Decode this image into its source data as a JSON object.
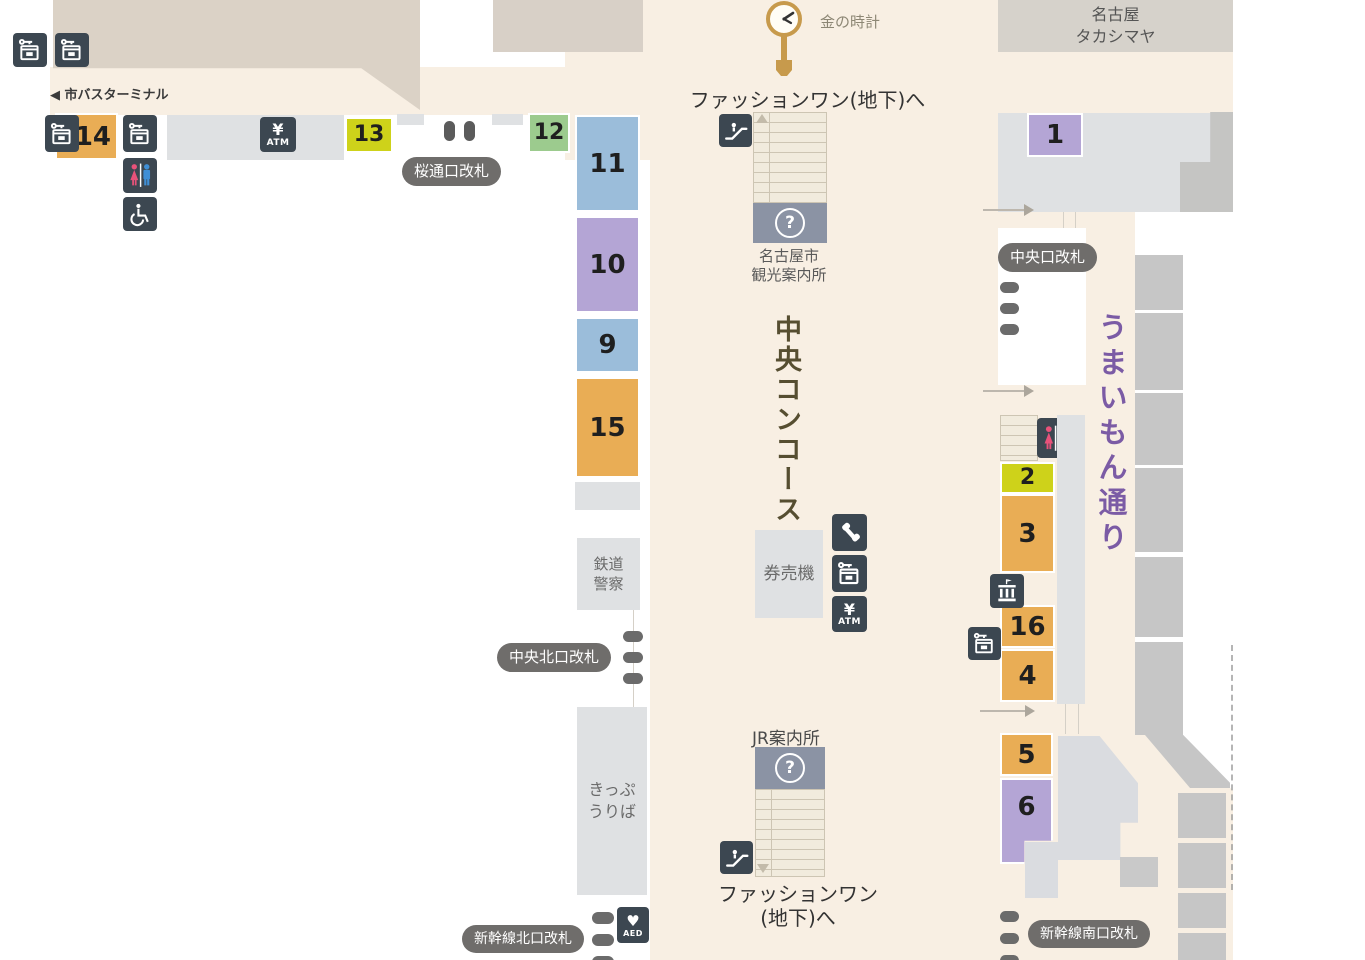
{
  "title": "Nagoya Station concourse floor map",
  "palette": {
    "background": "#ffffff",
    "concourse_beige": "#f8efe3",
    "building_tan": "#dbd2c6",
    "block_gray_light": "#dfe1e3",
    "block_gray_mid": "#c6c6c6",
    "icon_tile_dark": "#3c4751",
    "badge_gray": "#6f6d6b",
    "info_box_blue_gray": "#8b93a4",
    "spot_orange": "#e9ad55",
    "spot_yellow": "#ced21a",
    "spot_green": "#9ccb8e",
    "spot_blue": "#9bbdda",
    "spot_purple": "#b4a5d5",
    "concourse_text": "#564e31",
    "umaimon_text": "#7b5ba5",
    "clock_gold": "#c79a4c",
    "toilet_pink": "#e8527a",
    "toilet_blue": "#3f8fd6"
  },
  "labels": {
    "bus_terminal": "◀ 市バスターミナル",
    "gold_clock": "金の時計",
    "fashion_one_top": "ファッションワン(地下)へ",
    "tourist_info_line1": "名古屋市",
    "tourist_info_line2": "観光案内所",
    "takashimaya_line1": "名古屋",
    "takashimaya_line2": "タカシマヤ",
    "central_concourse": "中央コンコース",
    "umaimon_street": "うまいもん通り",
    "railway_police_line1": "鉄道",
    "railway_police_line2": "警察",
    "ticket_machines": "券売機",
    "ticket_office_line1": "きっぷ",
    "ticket_office_line2": "うりば",
    "jr_info": "JR案内所",
    "fashion_one_bottom_line1": "ファッションワン",
    "fashion_one_bottom_line2": "(地下)へ"
  },
  "badges": {
    "sakuradori_gate": "桜通口改札",
    "central_gate": "中央口改札",
    "central_north_gate": "中央北口改札",
    "shinkansen_north_gate": "新幹線北口改札",
    "shinkansen_south_gate": "新幹線南口改札"
  },
  "icon_glyphs": {
    "atm_yen": "¥",
    "atm_label": "ATM",
    "aed_heart": "♥",
    "aed_label": "AED",
    "info_question": "?"
  },
  "facility_icons": [
    "coin-locker",
    "restroom",
    "wheelchair-accessible",
    "atm",
    "public-phone",
    "escalator",
    "aed",
    "information",
    "public-building",
    "gold-clock"
  ],
  "spots": {
    "s1": {
      "label": "1",
      "color": "purple"
    },
    "s2": {
      "label": "2",
      "color": "yellow"
    },
    "s3": {
      "label": "3",
      "color": "orange"
    },
    "s4": {
      "label": "4",
      "color": "orange"
    },
    "s5": {
      "label": "5",
      "color": "orange"
    },
    "s6": {
      "label": "6",
      "color": "purple"
    },
    "s9": {
      "label": "9",
      "color": "blue"
    },
    "s10": {
      "label": "10",
      "color": "purple"
    },
    "s11": {
      "label": "11",
      "color": "blue"
    },
    "s12": {
      "label": "12",
      "color": "green"
    },
    "s13": {
      "label": "13",
      "color": "yellow"
    },
    "s14": {
      "label": "14",
      "color": "orange"
    },
    "s15": {
      "label": "15",
      "color": "orange"
    },
    "s16": {
      "label": "16",
      "color": "orange"
    }
  }
}
